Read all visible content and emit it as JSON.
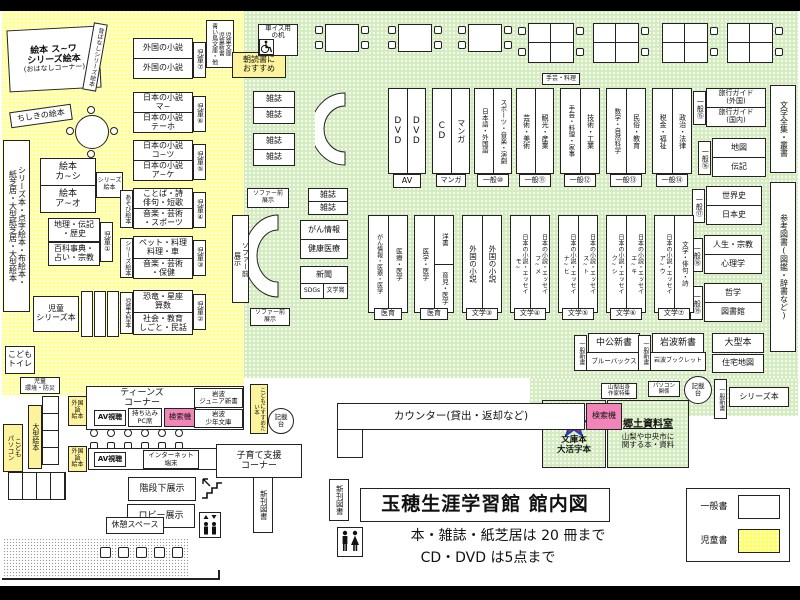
{
  "title": {
    "name": "玉穂生涯学習館 館内図",
    "rule1": "本・雑誌・紙芝居は 20 冊まで",
    "rule2": "CD・DVD は5点まで"
  },
  "legend": {
    "general": "一般書",
    "children": "児童書"
  },
  "colors": {
    "general_zone": "#d4ecc0",
    "children_zone": "#ffff9e",
    "search_pink": "#f285b8",
    "star_fill": "#e03030",
    "star_stroke": "#2238c8"
  },
  "c": {
    "ohanashi1": "絵本 ス~ワ\nシリーズ絵本",
    "ohanashi2": "(おはなしコーナー)",
    "mukashi": "昔ばなしシリーズ絵本",
    "chishiki": "ちしきの絵本",
    "leftstrip": "シリーズ本・点字絵本・布絵本・\n紙芝居・大型紙芝居・大型絵本",
    "ehon_ka": "絵本\nカ~シ",
    "ehon_a": "絵本\nア~オ",
    "series_ehon": "シリーズ絵本",
    "chiri": "地理・伝記\n・歴史",
    "hyakka": "百科事典・\n占い・宗教",
    "tag1": "児童①",
    "tag2": "児童②",
    "tag3": "児童③",
    "tag4": "児童④",
    "tag5": "児童⑤",
    "tag6": "児童⑥",
    "tag7": "児童⑦",
    "series_bon": "児童\nシリーズ本",
    "toilet": "こども\nトイレ",
    "gaikoku": "外国の小説",
    "nihon_ma": "日本の小説\nマ~",
    "nihon_te": "日本の小説\nテーホ",
    "nihon_ko": "日本の小説\nコ~ツ",
    "nihon_ake": "日本の小説\nア~ケ",
    "kotoba": "ことば・詩\n俳句・短歌",
    "onspo": "音楽・芸術\n・スポーツ",
    "asobi": "あそび絵本",
    "pet": "ペット・料理\n料理・車",
    "onhoken": "音楽・芸術\n・保健",
    "kyoryu": "恐竜・星座\n算数",
    "shakai": "社会・教育\nしごと・民話",
    "ogata_tag": "児童大型本",
    "jshinsho": "児童文庫\n児童新書\n青い鳥文庫・他",
    "asadoku": "朝読書に\nおすすめ",
    "kankyo": "児童\n環境・防災",
    "ogata_ehon": "大型絵本",
    "kodomo_pc": "こども\nパソコン"
  },
  "g": {
    "wheelchair": "車イス用\nの机",
    "zasshi": "雑誌",
    "dvd": "DVD",
    "cd": "CD",
    "manga": "マンガ",
    "av_tag": "AV",
    "manga_tag": "マンガ",
    "nihongo": "日本語・外国語",
    "sports": "スポーツ・音楽・演劇",
    "g10": "一般⑩",
    "geijutsu": "芸術・美術",
    "kanko": "観光・産業",
    "g11": "一般⑪",
    "shugei": "手芸・料理・家事",
    "gijutsu": "技術・工業",
    "g12": "一般⑫",
    "sugaku": "数学・自然科学",
    "minzoku": "民俗・教育",
    "g13": "一般⑬",
    "zeikin": "税金・福祉",
    "seiji": "政治・法律",
    "g14": "一般⑭",
    "shugei_tag": "手芸・料理",
    "travel1": "旅行ガイド\n(外国)",
    "travel2": "旅行ガイド\n(国内)",
    "g15": "一般⑮",
    "chizu": "地図",
    "denki": "伝記",
    "g16": "一般⑯",
    "sekaishi": "世界史",
    "nihonshi": "日本史",
    "g17": "一般⑰",
    "jinsei": "人生・宗教",
    "shinri": "心理学",
    "g18": "一般⑱",
    "tetsugaku": "哲学",
    "toshokan": "図書館",
    "g19": "一般⑲",
    "zenshu": "文学全集・叢書",
    "sanko": "参考図書(図鑑・辞書など)",
    "sofa": "ソファー前\n展示",
    "gan": "がん情報",
    "kenko": "健康医療",
    "shinbun": "新聞",
    "sdgs": "SDGs",
    "bungakusho": "文学賞",
    "med1l": "がん情報・医療・医学",
    "med1r": "医療・医学",
    "med_tag": "医育",
    "med2l": "医学・医学",
    "yosho": "洋書",
    "ikuji": "育児・医学",
    "lit3": "文学③",
    "lit4": "文学④",
    "lit5": "文学⑤",
    "lit6": "文学⑥",
    "lit7": "文学⑦",
    "ness_mo": "日本の小説・エッセイ\nモ~",
    "ness_fu": "日本の小説・エッセイ\nフ~メ",
    "ness_na": "日本の小説・エッセイ\nナ~ヒ",
    "ness_su": "日本の小説・エッセイ\nス~ト",
    "ness_ku": "日本の小説・エッセイ\nク~シ",
    "ness_e": "日本の小説・エッセイ\nエ~キ",
    "ness_a": "日本の小説・エッセイ\nア~ウ",
    "bungaku_haiku": "文学・俳句・詩",
    "chuko": "中公新書",
    "blue": "ブルーバックス",
    "shinsho_tag": "一般新書",
    "iwanami": "岩波新書",
    "booklet": "岩波ブックレット",
    "ogata": "大型本",
    "jutaku": "住宅地図",
    "yamanashi": "山梨出身\n作家特集",
    "pc_kankei": "パソコン\n関係",
    "kisaidai": "記載\n台",
    "series": "シリーズ本"
  },
  "b": {
    "counter": "カウンター(貸出・返却など)",
    "kensaku": "検索機",
    "kyodo_title": "郷土資料室",
    "kyodo_sub": "山梨や中央市に\n関する本・資料",
    "bunko": "文庫本\n大活字本",
    "susume": "こどもにすすめたい本",
    "teens": "ティーンズ\nコーナー",
    "av": "AV視聴",
    "pc_seat": "持ち込み\nPC席",
    "iwanami_jr": "岩波\nジュニア新書",
    "iwanami_sh": "岩波\n少年文庫",
    "gaikokugo": "外国語\n絵本",
    "internet": "インターネット\n端末",
    "kosodate": "子育て支援\nコーナー",
    "kaidan": "階段下展示",
    "lobby": "ロビー展示",
    "kyukei": "休憩スペース",
    "shinkan": "新刊図書"
  }
}
